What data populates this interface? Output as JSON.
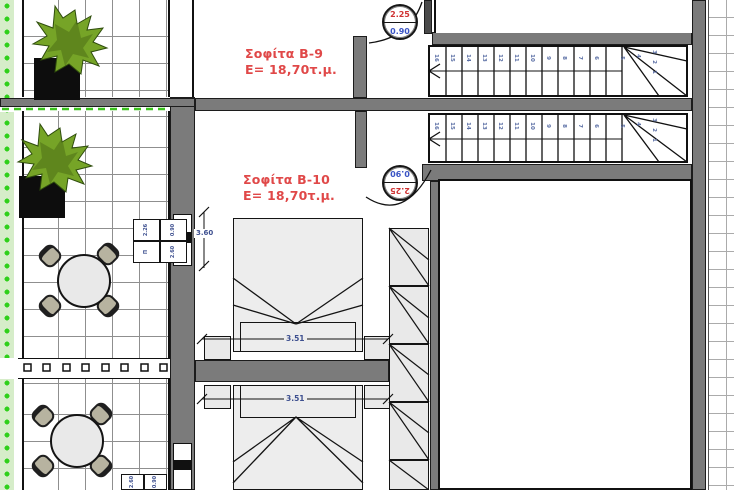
{
  "units": [
    {
      "label": "Σοφίτα B-9",
      "area": "E= 18,70τ.μ."
    },
    {
      "label": "Σοφίτα B-10",
      "area": "E= 18,70τ.μ."
    }
  ],
  "door_markers": [
    {
      "top": "2.25",
      "bottom": "0.90"
    },
    {
      "top": "2.25",
      "bottom": "0.90"
    }
  ],
  "stairs": {
    "run1": [
      "16",
      "15",
      "14",
      "13",
      "12",
      "11",
      "10",
      "9",
      "8",
      "7",
      "6"
    ],
    "run1_winder": [
      "5",
      "4",
      "3",
      "2",
      "1"
    ],
    "run2": [
      "16",
      "15",
      "14",
      "13",
      "12",
      "11",
      "10",
      "9",
      "8",
      "7",
      "6"
    ],
    "run2_winder": [
      "5",
      "4",
      "3",
      "2",
      "1"
    ]
  },
  "dimensions": {
    "bed_top": "3.51",
    "bed_bottom": "3.51",
    "wall_left": "3.60"
  },
  "info_box_1": {
    "c1": "2.26",
    "c2": "0.90",
    "c3": "Π",
    "c4": "2.60"
  },
  "info_box_2": {
    "c1": "2.60",
    "c2": "0.90"
  },
  "colors": {
    "label_red": "#e04848",
    "dim_blue": "#3d4f8f",
    "marker_red": "#cf3333",
    "marker_blue": "#3a54c4",
    "wall_gray": "#7b7b7b",
    "plant_green": "#76a427",
    "lawn_strip_green": "#d6edc9",
    "lawn_dot_green": "#2fd01a"
  }
}
